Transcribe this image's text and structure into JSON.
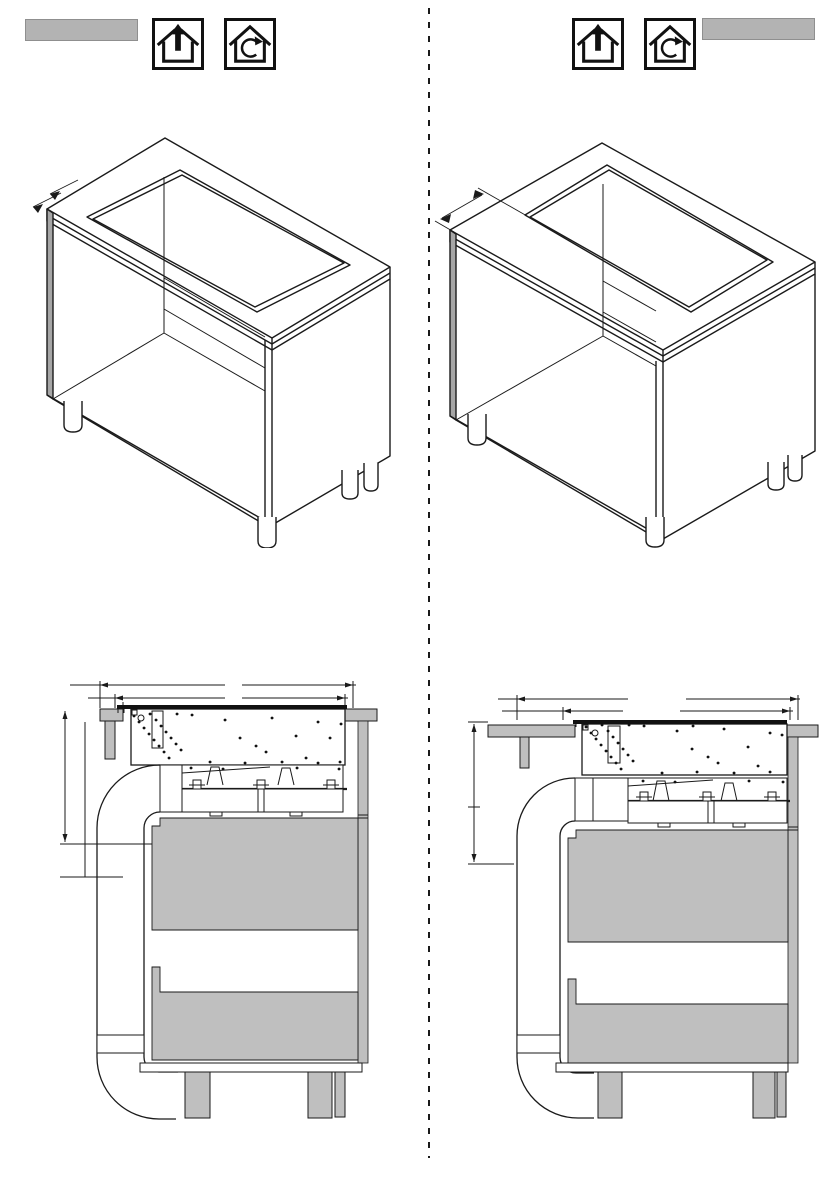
{
  "page": {
    "kind": "appliance-installation-manual-page",
    "visible_text": "none"
  },
  "colors": {
    "page-bg": "#ffffff",
    "line": "#1a1a1a",
    "gray-bar": "#b3b3b3",
    "gray-fill": "#bfbfbf",
    "gray-dark": "#a6a6a6"
  },
  "divider": {
    "style": "dashed-vertical-column-separator"
  },
  "header": {
    "left": {
      "redacted_label_text": "",
      "icons": [
        {
          "name": "exhaust-air-house-arrow-up-icon",
          "label": "exhaust air mode"
        },
        {
          "name": "recirculation-house-loop-icon",
          "label": "recirculation mode"
        }
      ]
    },
    "right": {
      "icons": [
        {
          "name": "exhaust-air-house-arrow-up-icon",
          "label": "exhaust air mode"
        },
        {
          "name": "recirculation-house-loop-icon",
          "label": "recirculation mode"
        }
      ],
      "redacted_label_text": ""
    }
  },
  "figures": {
    "top_left": {
      "name": "isometric-cabinet-worktop-cutout-near-front-edge"
    },
    "top_right": {
      "name": "isometric-cabinet-worktop-cutout-set-back"
    },
    "bottom_left": {
      "name": "cross-section-hob-with-downdraft-duct-variant-1"
    },
    "bottom_right": {
      "name": "cross-section-hob-with-downdraft-duct-variant-2"
    }
  }
}
